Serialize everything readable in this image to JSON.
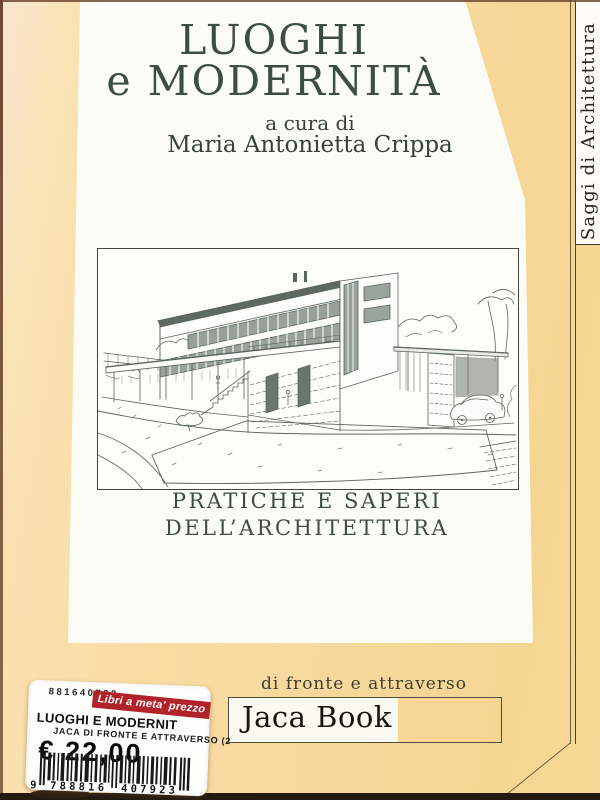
{
  "book_cover": {
    "title_line1": "LUOGHI",
    "title_line2": "e MODERNITÀ",
    "curated_by": "a cura di",
    "curator": "Maria Antonietta Crippa",
    "subtitle_line1": "PRATICHE E SAPERI",
    "subtitle_line2": "DELL’ARCHITETTURA",
    "series": "Saggi di Architettura",
    "collection": "di fronte e attraverso",
    "publisher": "Jaca Book"
  },
  "illustration": {
    "description": "pencil perspective sketch of a modernist villa with canopy, stairs, garden court and parked car"
  },
  "price_sticker": {
    "store_code": "881640792",
    "promo_tag": "Libri a meta' prezzo",
    "book_title": "LUOGHI E MODERNIT",
    "book_info": "JACA DI FRONTE E ATTRAVERSO (2",
    "price": "€ 22,00",
    "barcode": {
      "lead_digit": "9",
      "group1": "788816",
      "group2": "407923"
    }
  },
  "colors": {
    "cover_tan": "#f8dda2",
    "cover_tan_light": "#f8e5c8",
    "panel_white": "#fcfcf6",
    "title_green": "#3d4d43",
    "promo_red": "#b2222b",
    "ink_dark": "#16160f"
  }
}
